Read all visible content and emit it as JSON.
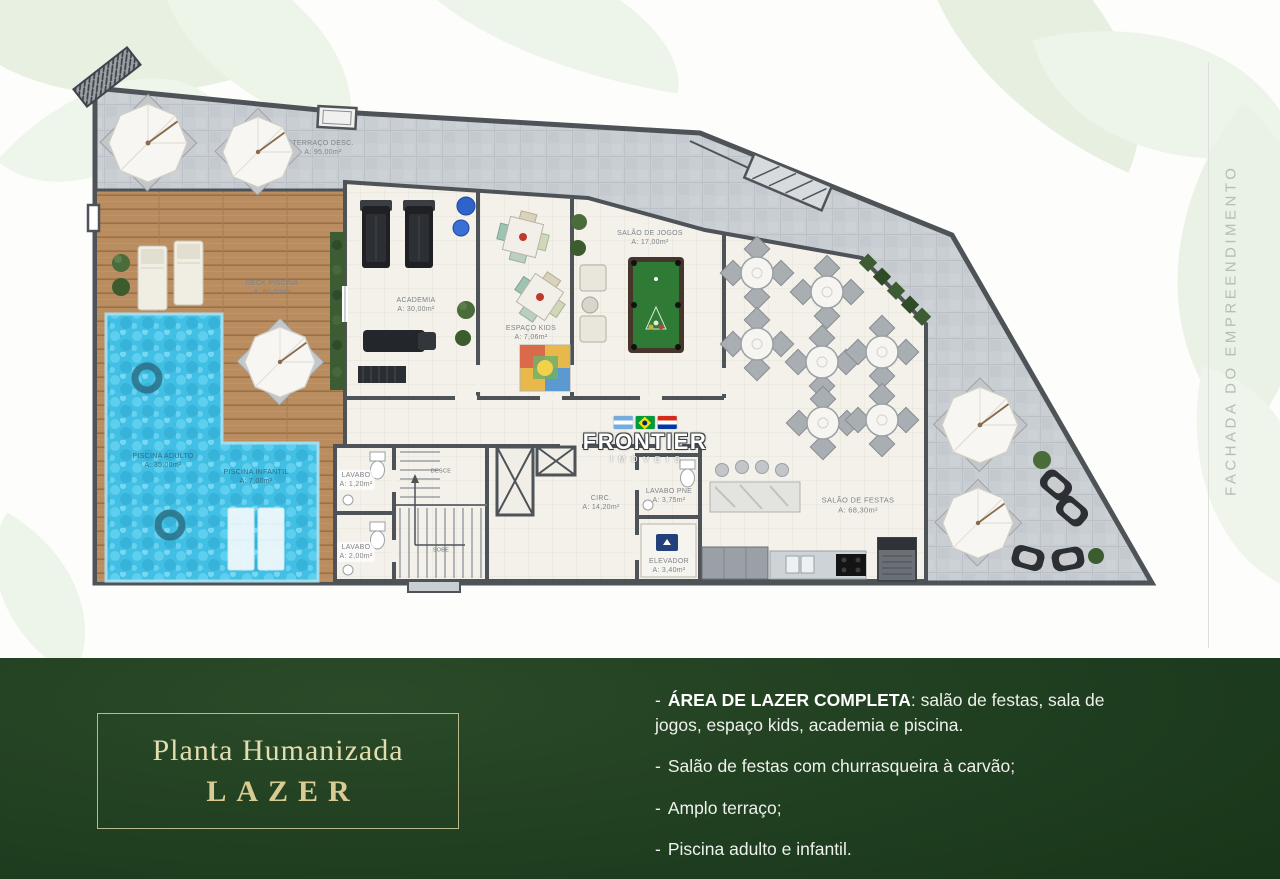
{
  "fachada": {
    "text": "FACHADA DO EMPREENDIMENTO"
  },
  "watermark": {
    "brand": "FRONTIER",
    "sub": "IMÓVEIS",
    "flags": [
      "argentina-flag",
      "brazil-flag",
      "paraguay-flag"
    ]
  },
  "plan": {
    "rooms": {
      "terraco": {
        "name": "TERRAÇO DESC.",
        "area": "A: 95,00m²"
      },
      "deck": {
        "name": "DECK PISCINA",
        "area": "A: 80,00m²"
      },
      "piscina_adulto": {
        "name": "PISCINA ADULTO",
        "area": "A: 35,00m²"
      },
      "piscina_infantil": {
        "name": "PISCINA INFANTIL",
        "area": "A: 7,00m²"
      },
      "academia": {
        "name": "ACADEMIA",
        "area": "A: 30,00m²"
      },
      "espaco_kids": {
        "name": "ESPAÇO KIDS",
        "area": "A: 7,06m²"
      },
      "salao_jogos": {
        "name": "SALÃO DE JOGOS",
        "area": "A: 17,00m²"
      },
      "lavabo1": {
        "name": "LAVABO",
        "area": "A: 1,20m²"
      },
      "lavabo2": {
        "name": "LAVABO",
        "area": "A: 2,00m²"
      },
      "circ": {
        "name": "CIRC.",
        "area": "A: 14,20m²"
      },
      "lavabo_pne": {
        "name": "LAVABO PNE",
        "area": "A: 3,75m²"
      },
      "elevador": {
        "name": "ELEVADOR",
        "area": "A: 3,40m²"
      },
      "salao_festas": {
        "name": "SALÃO DE FESTAS",
        "area": "A: 68,30m²"
      }
    },
    "stairs": {
      "up": "SOBE",
      "down": "DESCE"
    }
  },
  "footer": {
    "dash": "-",
    "plate": {
      "line1": "Planta Humanizada",
      "line2": "LAZER"
    },
    "bullets": [
      {
        "bold": "ÁREA DE LAZER COMPLETA",
        "rest": ": salão de festas, sala de jogos, espaço kids, academia e piscina."
      },
      {
        "bold": "",
        "rest": "Salão de festas com churrasqueira à carvão;"
      },
      {
        "bold": "",
        "rest": "Amplo terraço;"
      },
      {
        "bold": "",
        "rest": "Piscina adulto e infantil."
      }
    ]
  }
}
